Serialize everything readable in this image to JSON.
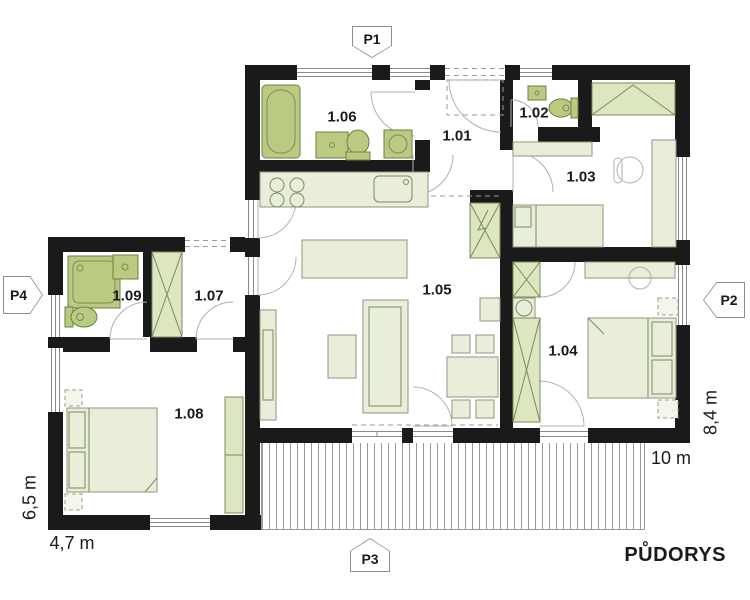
{
  "title": "PŮDORYS",
  "markers": [
    {
      "label": "P1",
      "position": "top"
    },
    {
      "label": "P2",
      "position": "right"
    },
    {
      "label": "P3",
      "position": "bottom"
    },
    {
      "label": "P4",
      "position": "left"
    }
  ],
  "rooms": [
    {
      "label": "1.01"
    },
    {
      "label": "1.02"
    },
    {
      "label": "1.03"
    },
    {
      "label": "1.04"
    },
    {
      "label": "1.05"
    },
    {
      "label": "1.06"
    },
    {
      "label": "1.07"
    },
    {
      "label": "1.08"
    },
    {
      "label": "1.09"
    }
  ],
  "dimensions": {
    "left_wing_height": "6,5 m",
    "left_wing_width": "4,7 m",
    "main_width": "10 m",
    "main_height": "8,4 m"
  },
  "fixtures": [
    "bathtub",
    "washbasin",
    "toilet",
    "washing-machine",
    "shower",
    "kitchen-stove",
    "kitchen-sink",
    "kitchen-island",
    "sofa",
    "coffee-table",
    "tv-bench",
    "dining-table",
    "chair",
    "double-bed",
    "single-bed",
    "wardrobe",
    "desk",
    "office-chair",
    "fireplace",
    "terrace-decking"
  ],
  "colors": {
    "walls": "#1a1a1a",
    "furniture_light": "#e9eedb",
    "furniture_mid": "#dce6c0",
    "fixtures_green": "#b9cb80",
    "lines": "#9a9a9a",
    "background": "#ffffff"
  }
}
